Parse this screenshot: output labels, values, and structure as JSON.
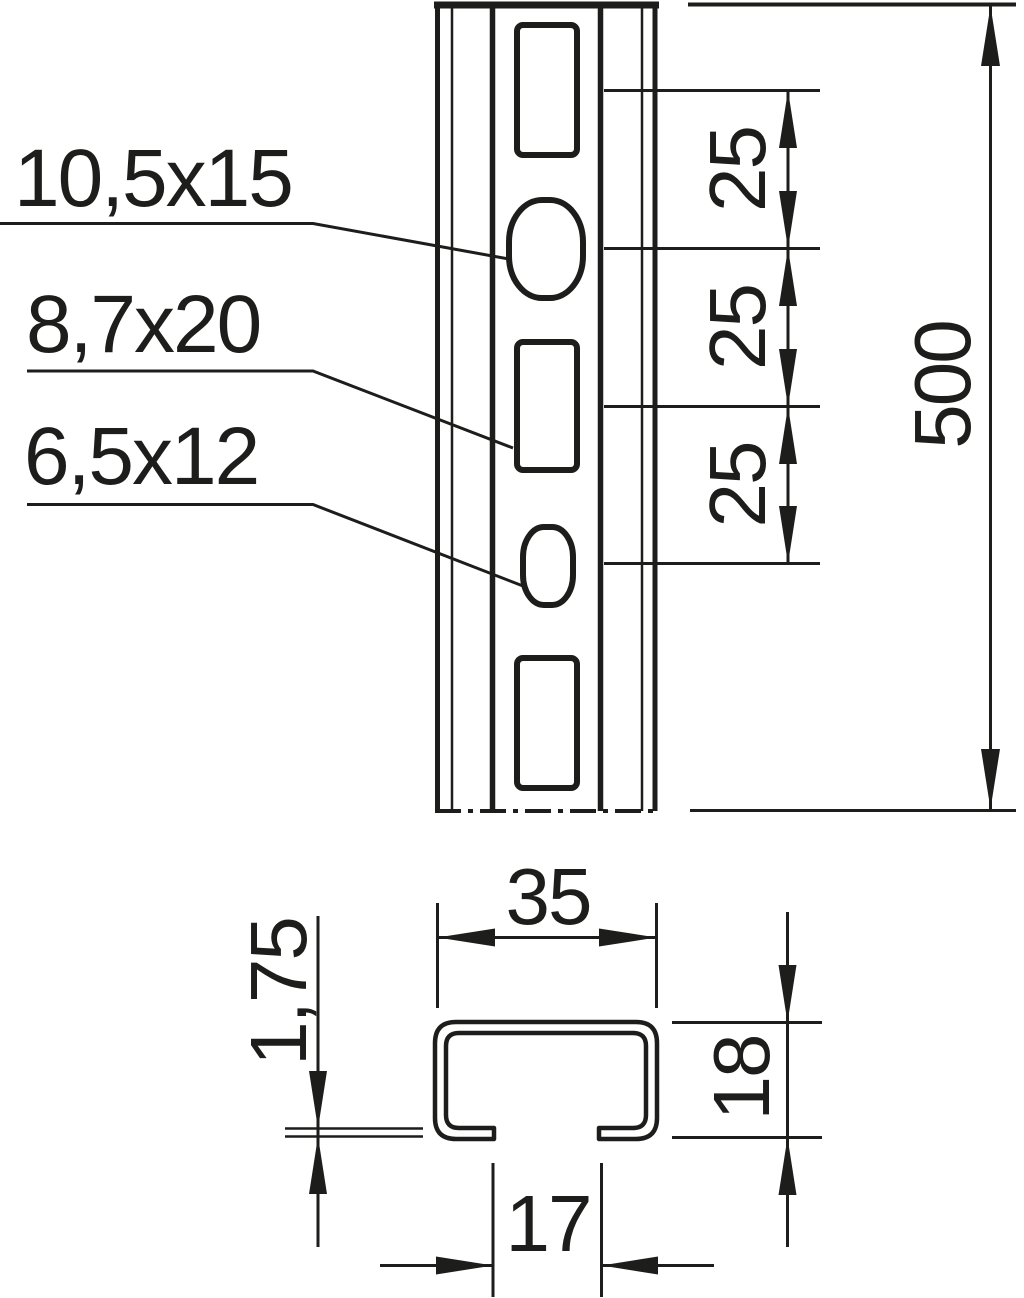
{
  "drawing": {
    "background": "#ffffff",
    "line_color": "#1d1d1b",
    "front_view": {
      "hole_labels": [
        {
          "text": "10,5x15"
        },
        {
          "text": "8,7x20"
        },
        {
          "text": "6,5x12"
        }
      ],
      "pitch_dimensions": [
        "25",
        "25",
        "25"
      ],
      "length_dimension": "500"
    },
    "cross_section": {
      "width_dimension": "35",
      "thickness_dimension": "1,75",
      "height_dimension": "18",
      "opening_dimension": "17"
    }
  }
}
